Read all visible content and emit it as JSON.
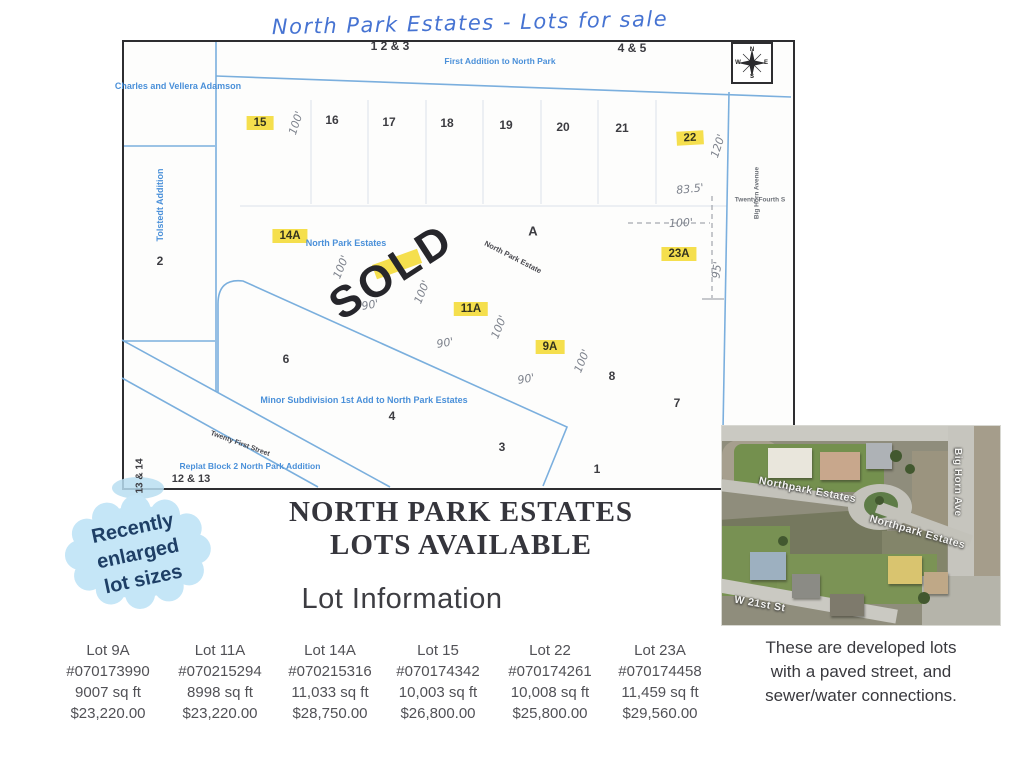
{
  "title_handwritten": "North Park Estates - Lots for sale",
  "map": {
    "labels": {
      "top_left_lots": "1 2 & 3",
      "top_right_lots": "4 & 5",
      "first_addition": "First Addition to North Park",
      "owner": "Charles and Vellera Adamson",
      "tolstedt": "Tolstedt Addition",
      "north_park_estates": "North Park Estates",
      "north_park_estate_diag": "North Park Estate",
      "minor_subdivision": "Minor Subdivision 1st Add to North Park Estates",
      "twenty_first_street": "Twenty First Street",
      "replat": "Replat Block 2 North Park Addition",
      "big_horn_avenue": "Big Horn Avenue",
      "twenty_fourth_street": "Twenty Fourth S",
      "block_a": "A",
      "sold": "SOLD"
    },
    "lot_numbers": {
      "n1": "1",
      "n2": "2",
      "n3": "3",
      "n4": "4",
      "n6": "6",
      "n7": "7",
      "n8": "8",
      "n16": "16",
      "n17": "17",
      "n18": "18",
      "n19": "19",
      "n20": "20",
      "n21": "21",
      "n1213": "12 & 13",
      "n1314": "13 & 14"
    },
    "highlighted": {
      "h15": "15",
      "h22": "22",
      "h14a": "14A",
      "h23a": "23A",
      "h11a": "11A",
      "h9a": "9A"
    },
    "measurements": {
      "hundred": "100'",
      "ninety": "90'",
      "one_twenty": "120'",
      "eighty_three_half": "83.5'",
      "ninety_five": "95'"
    },
    "compass": {
      "n": "N",
      "e": "E",
      "s": "S",
      "w": "W"
    }
  },
  "badge": {
    "line1": "Recently",
    "line2": "enlarged",
    "line3": "lot sizes"
  },
  "heading": {
    "line1": "NORTH PARK ESTATES",
    "line2": "LOTS AVAILABLE",
    "sub": "Lot Information"
  },
  "lots": [
    {
      "name": "Lot 9A",
      "parcel": "#070173990",
      "size": "9007 sq ft",
      "price": "$23,220.00"
    },
    {
      "name": "Lot 11A",
      "parcel": "#070215294",
      "size": "8998 sq ft",
      "price": "$23,220.00"
    },
    {
      "name": "Lot 14A",
      "parcel": "#070215316",
      "size": "11,033 sq ft",
      "price": "$28,750.00"
    },
    {
      "name": "Lot 15",
      "parcel": "#070174342",
      "size": "10,003 sq ft",
      "price": "$26,800.00"
    },
    {
      "name": "Lot 22",
      "parcel": "#070174261",
      "size": "10,008 sq ft",
      "price": "$25,800.00"
    },
    {
      "name": "Lot 23A",
      "parcel": "#070174458",
      "size": "11,459 sq ft",
      "price": "$29,560.00"
    }
  ],
  "aerial": {
    "street_upper": "Northpark Estates",
    "street_lower": "Northpark Estates",
    "avenue": "Big Horn Ave",
    "street_bottom": "W 21st St"
  },
  "note": {
    "line1": "These are developed lots",
    "line2": "with a paved street, and",
    "line3": "sewer/water connections."
  },
  "colors": {
    "highlight": "#f5df4d",
    "map_line_blue": "#74abdc",
    "map_text_blue": "#4a90d9",
    "pen_blue": "#4673d2",
    "badge_bg": "#c5e6f7",
    "badge_text": "#1e3f66"
  }
}
